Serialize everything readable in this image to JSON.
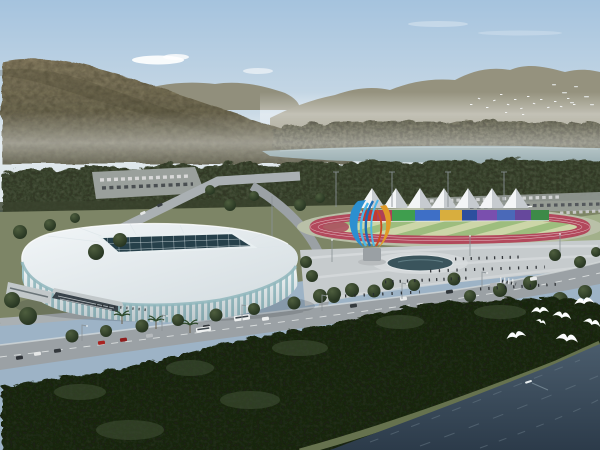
{
  "scene": {
    "type": "architectural-rendering",
    "description": "Aerial rendering of a white lattice-facade gymnasium beside an athletics track sports park, between forested mountains, a river valley and a dark foreground river with flying white birds",
    "time_of_day": "day"
  },
  "colors": {
    "sky_top": "#a5c3de",
    "sky_horizon": "#dfe7ea",
    "cloud": "#ffffff",
    "ridge_far": "#95927e",
    "ridge_mid": "#8e8b76",
    "mountain_top": "#887e62",
    "mountain_base": "#5e5d47",
    "tree_far": "#6f6d57",
    "tree_belt": "#4b543d",
    "tree_belt_dark": "#39422d",
    "river": "#8aa2a6",
    "river_edge": "#b6c6c8",
    "grass": "#7d8566",
    "grass_pale": "#a2b08a",
    "parking": "#9aa09c",
    "road": "#9ba1a5",
    "road_light": "#aab0b3",
    "road_line": "#d9dddd",
    "plaza": "#c6cbcd",
    "plaza_light": "#d8dcde",
    "apron": "#b9c0a8",
    "track_red": "#b2495c",
    "field_light": "#ccd6a8",
    "field_dark": "#9dbd7e",
    "d_zone": "#ad5260",
    "rail_white": "#e9ecec",
    "tent_white": "#f3f5f6",
    "tent_shade": "#c6cbcf",
    "roof_light": "#f2f6f8",
    "roof_shade": "#d3dce0",
    "rib_white": "#f4f8f9",
    "glass": "#a4c9ce",
    "clerestory": "#8fb6bc",
    "skylight": "#26404a",
    "skylight_line": "#dfe9ec",
    "skylight_frame": "#e8eff1",
    "entrance_dark": "#39434a",
    "annex": "#c2c8ca",
    "fountain": "#3a545c",
    "fountain_rim": "#e0e4e6",
    "sculpture_blue": "#2b8fd0",
    "sculpture_blue_light": "#49b6e8",
    "sculpture_blue_dark": "#1d6cb4",
    "sculpture_orange": "#e09a28",
    "sculpture_red": "#cc4a22",
    "pedestal": "#9aa0a4",
    "tree_round_hi": "#4e5e3e",
    "tree_round_lo": "#22301e",
    "forest": "#26321f",
    "forest_hi": "#3e4e33",
    "shore_grass": "#66724e",
    "water_top": "#4a5c6c",
    "water_deep": "#2c3b4a",
    "wave": "#70828e",
    "gull": "#fbfdfd",
    "flock": "#f8fafb",
    "scree": "#e8ecec",
    "people": "#272b2f",
    "pole": "#8a9296",
    "shadow": "#20262a",
    "bus_window": "#3c444a"
  },
  "park": {
    "tent_count": 7,
    "wall_segments": [
      "#c03a33",
      "#ad4058",
      "#3f9e4e",
      "#3e6fc6",
      "#d8ae3e",
      "#2c4f9e",
      "#7a4fae",
      "#4a69b8",
      "#66489c",
      "#3d8a48"
    ]
  },
  "vehicles": {
    "bus_color": "#eef0f0",
    "car_colors": [
      "#2f3338",
      "#e6e8e8",
      "#33383c",
      "#a82320",
      "#8f1d1d",
      "#b6babd",
      "#2f3338",
      "#eceeee",
      "#9aa0a3",
      "#343a3e",
      "#e8eaea",
      "#30363a",
      "#b2b6b9",
      "#e9ebeb",
      "#e4e6e6",
      "#383e42"
    ]
  },
  "birds": {
    "large_gulls": 7,
    "distant_flock": 18
  }
}
